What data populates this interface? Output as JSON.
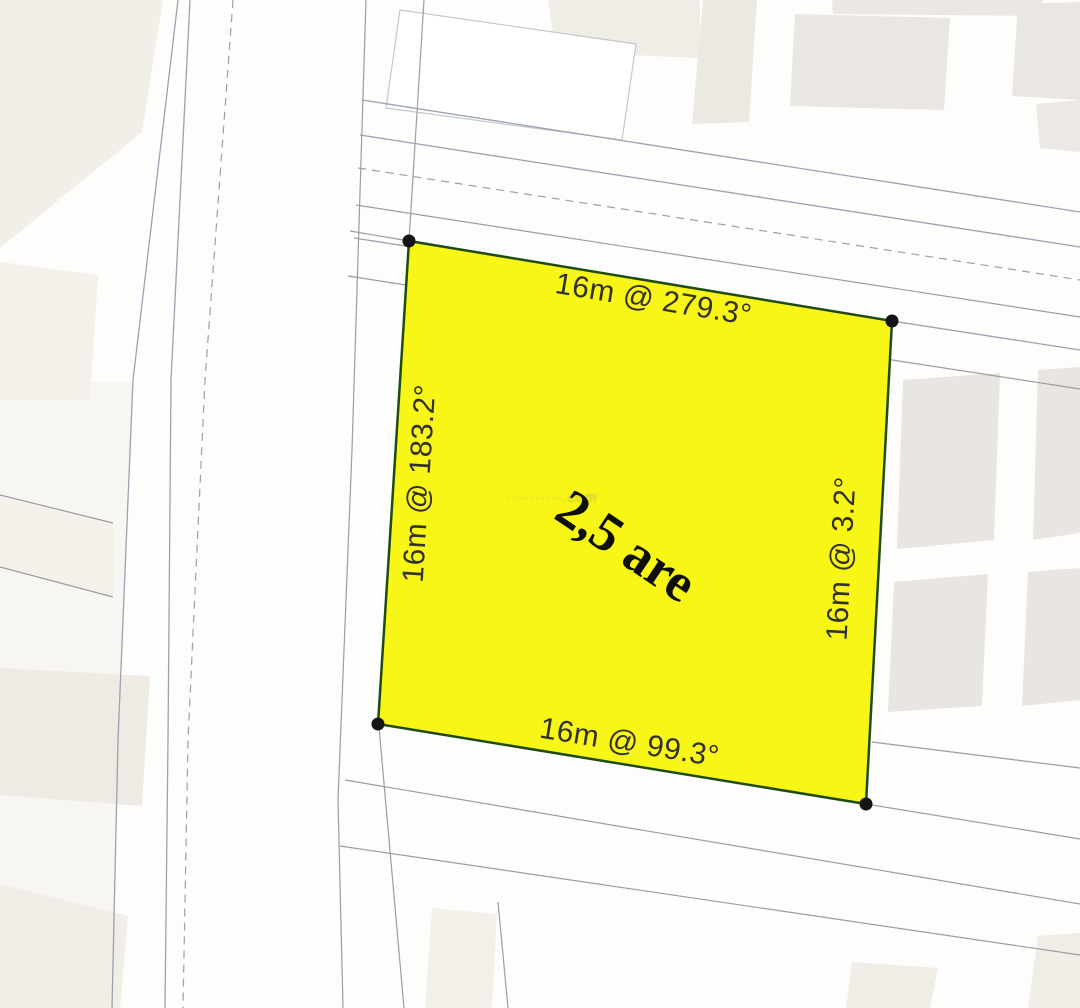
{
  "map": {
    "parcel": {
      "area_label": "2,5 are",
      "area_are": "2,5",
      "side_length_m": 16,
      "edges": {
        "top": "16m @ 279.3°",
        "left": "16m @ 183.2°",
        "right": "16m @ 3.2°",
        "bottom": "16m @ 99.3°"
      },
      "bearings_deg": {
        "top": 279.3,
        "left": 183.2,
        "right": 3.2,
        "bottom": 99.3
      }
    },
    "watermark": "··········.com",
    "colors": {
      "parcel_fill": "#f8f616",
      "parcel_stroke": "#1f4a14",
      "vertex": "#141414",
      "label_text": "#33312c",
      "road_line": "#9aa3ae",
      "block_beige": "#f0ece5",
      "block_gray": "#e9e6e1"
    }
  }
}
